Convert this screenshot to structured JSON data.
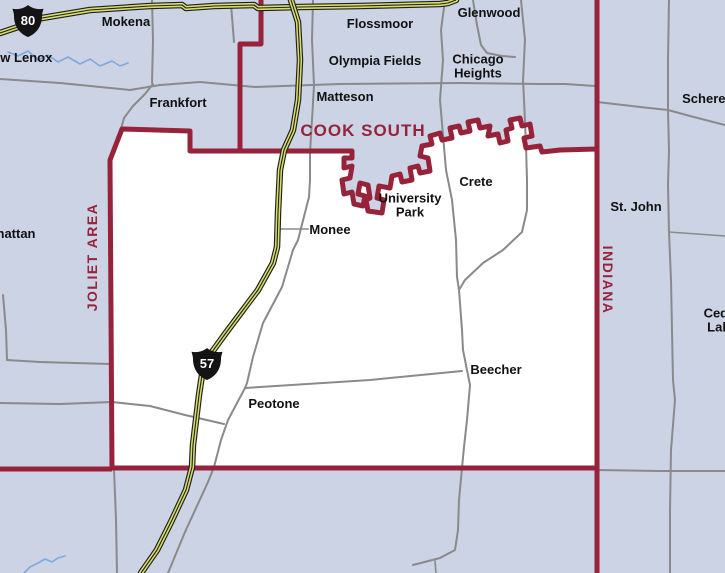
{
  "map": {
    "districts": {
      "cook_south": "COOK SOUTH",
      "joliet_area": "JOLIET AREA",
      "indiana": "INDIANA"
    },
    "towns": {
      "mokena": "Mokena",
      "new_lenox": "New Lenox",
      "flossmoor": "Flossmoor",
      "glenwood": "Glenwood",
      "olympia_fields": "Olympia Fields",
      "chicago_heights": "Chicago Heights",
      "frankfort": "Frankfort",
      "matteson": "Matteson",
      "schererville": "Schererville",
      "manhattan": "Manhattan",
      "monee": "Monee",
      "university_park": "University Park",
      "crete": "Crete",
      "st_john": "St. John",
      "beecher": "Beecher",
      "peotone": "Peotone",
      "cedar_lake": "Cedar Lake"
    },
    "shields": {
      "i80": "80",
      "i57": "57"
    },
    "colors": {
      "background": "#cbd3e5",
      "district_fill": "#ffffff",
      "boundary": "#96233a",
      "road": "#8a8a8a",
      "highway": "#d7de6c",
      "highway_casing": "#1f1f1f",
      "river": "#7fa8dd",
      "label": "#111111"
    }
  }
}
